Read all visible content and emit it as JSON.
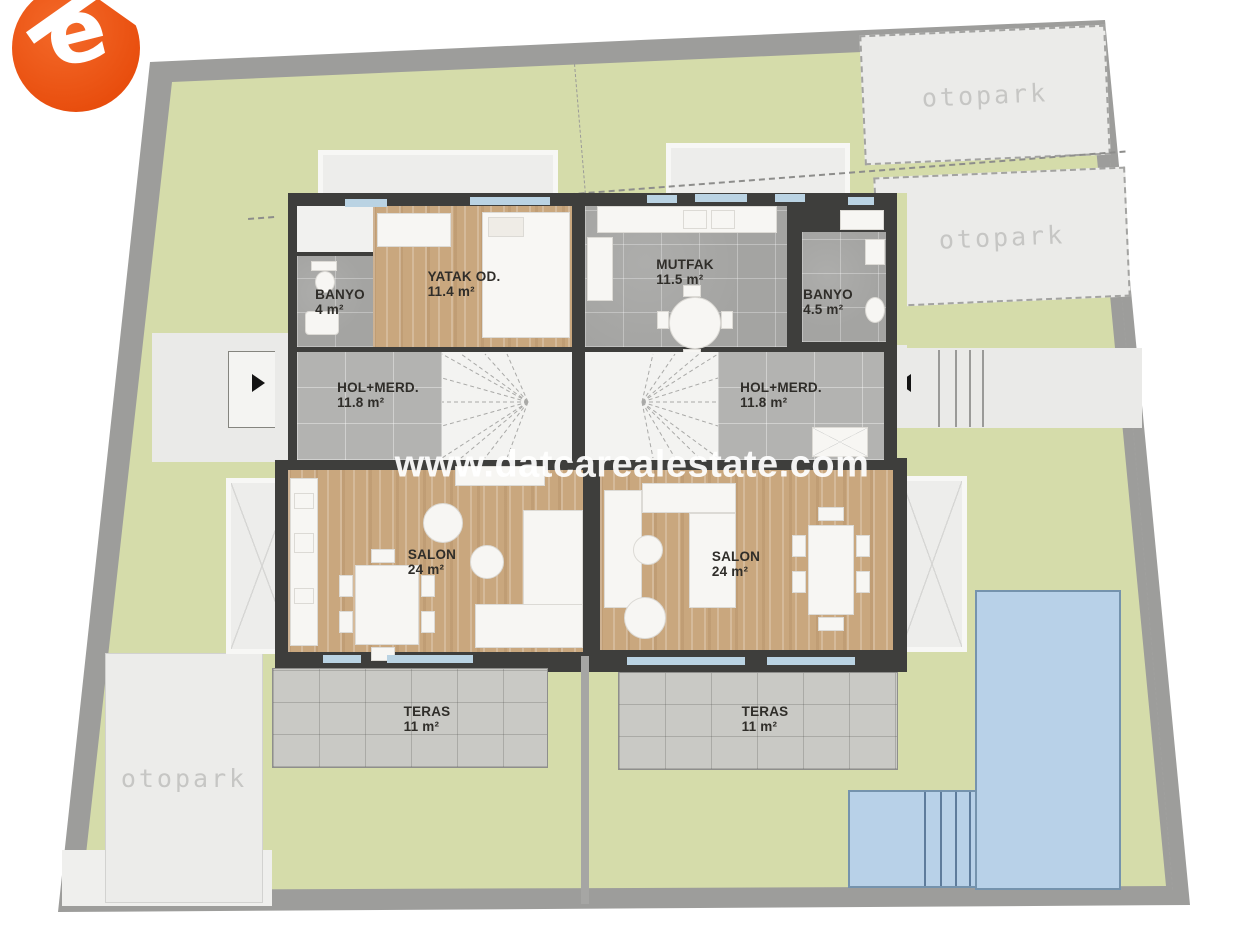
{
  "watermark": "www.datcarealestate.com",
  "logo": {
    "letter": "e"
  },
  "parking": {
    "top_first": "otopark",
    "top_second": "otopark",
    "bottom": "otopark"
  },
  "units": {
    "left": {
      "banyo": {
        "name": "BANYO",
        "area": "4 m²"
      },
      "yatak": {
        "name": "YATAK OD.",
        "area": "11.4 m²"
      },
      "hol": {
        "name": "HOL+MERD.",
        "area": "11.8 m²"
      },
      "salon": {
        "name": "SALON",
        "area": "24 m²"
      },
      "teras": {
        "name": "TERAS",
        "area": "11 m²"
      }
    },
    "right": {
      "mutfak": {
        "name": "MUTFAK",
        "area": "11.5 m²"
      },
      "banyo": {
        "name": "BANYO",
        "area": "4.5 m²"
      },
      "hol": {
        "name": "HOL+MERD.",
        "area": "11.8 m²"
      },
      "salon": {
        "name": "SALON",
        "area": "24 m²"
      },
      "teras": {
        "name": "TERAS",
        "area": "11 m²"
      }
    }
  },
  "colors": {
    "lawn": "#d5dcaa",
    "road": "#9d9d9b",
    "wall": "#3e3e3c",
    "wood_floor": "#c9a77e",
    "gray_tile": "#a4a4a2",
    "terrace_stone": "#c9c9c5",
    "pool": "#b8d1e8",
    "pool_border": "#7593ad",
    "window": "#bad3e3",
    "parking_fill": "#ebebe9",
    "logo_orange": "#ee5412",
    "watermark_white": "#ffffff"
  }
}
